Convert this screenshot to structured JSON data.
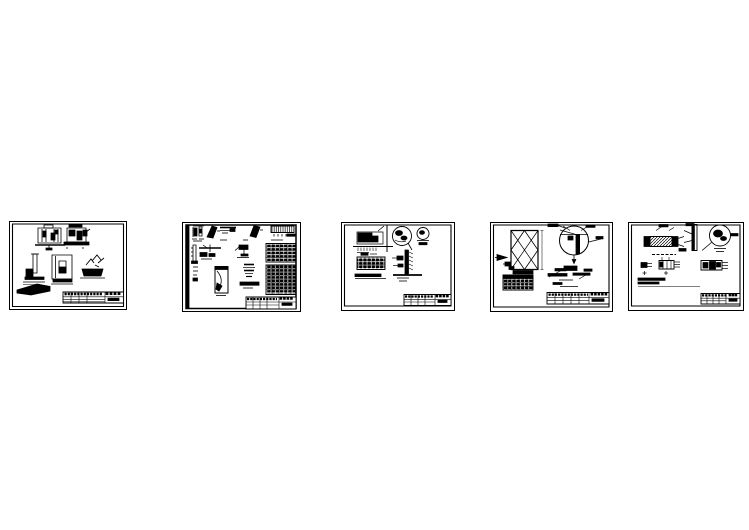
{
  "document": {
    "type": "cad-drawing-preview",
    "background_color": "#ffffff",
    "ink_color": "#000000",
    "sheet_count": 5
  },
  "sheets": [
    {
      "name": "detail-sheet-1"
    },
    {
      "name": "detail-sheet-2"
    },
    {
      "name": "detail-sheet-3"
    },
    {
      "name": "detail-sheet-4"
    },
    {
      "name": "detail-sheet-5"
    }
  ]
}
